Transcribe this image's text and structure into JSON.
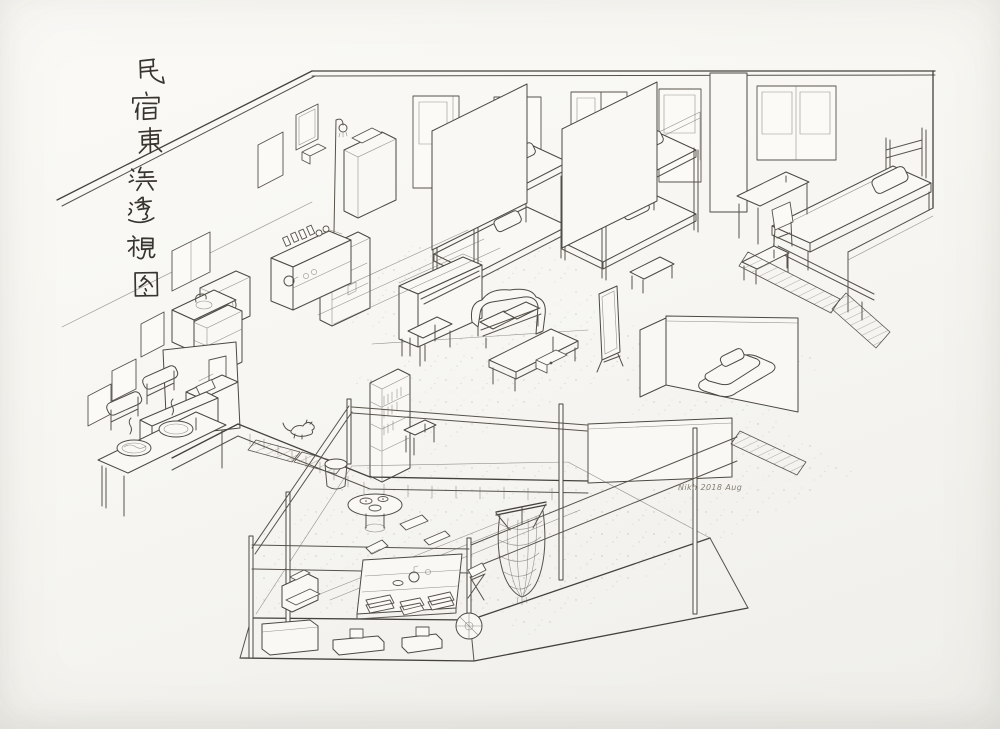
{
  "title": {
    "text": "民宿東浜透視图",
    "chars": [
      "民",
      "宿",
      "東",
      "浜",
      "透",
      "視",
      "图"
    ]
  },
  "signature": {
    "text": "Nikh 2018 Aug"
  },
  "colors": {
    "paper": "#f7f6f2",
    "ink": "#4c4841",
    "calligraphy": "#38352f"
  }
}
